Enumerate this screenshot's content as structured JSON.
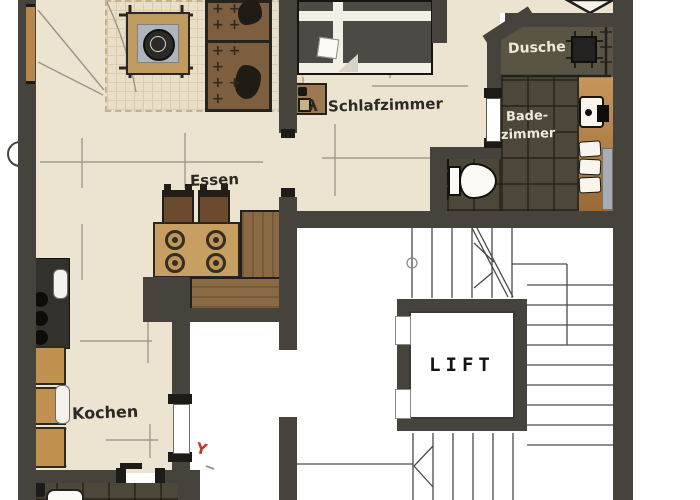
{
  "title": "Apartment floor plan with stairwell and lift",
  "labels": {
    "dining": "Essen",
    "bedroom": "Schlafzimmer",
    "shower": "Dusche",
    "bathroom_line1": "Bade-",
    "bathroom_line2": "zimmer",
    "kitchen": "Kochen",
    "lift": "LIFT",
    "lamp_symbol": "λ",
    "red_annotation": "Y"
  },
  "rooms": [
    {
      "name": "Essen",
      "type": "dining area"
    },
    {
      "name": "Schlafzimmer",
      "type": "bedroom"
    },
    {
      "name": "Dusche",
      "type": "shower"
    },
    {
      "name": "Badezimmer",
      "type": "bathroom"
    },
    {
      "name": "Kochen",
      "type": "kitchen"
    },
    {
      "name": "LIFT",
      "type": "elevator"
    }
  ],
  "colors": {
    "wall": "#45433c",
    "floor": "#ece3d0",
    "rug": "#e9dfc8",
    "bath_tile": "#4c4738",
    "shower_floor": "#5a5444",
    "wood_vanity": "#c6965a",
    "bench": "#8a6a45",
    "table": "#c89f62",
    "sofa": "#7d5e3e",
    "bed": "#4b4a44",
    "stair_line": "#4a4a47",
    "dim_line": "#a29c8e",
    "label_dark": "#2c2925",
    "label_light": "#efe9d8",
    "accent_red": "#c0392b"
  }
}
